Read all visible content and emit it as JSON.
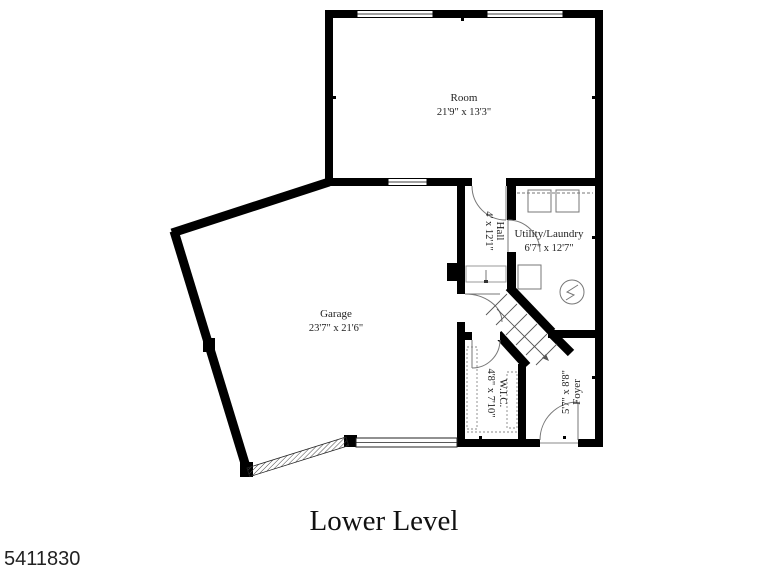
{
  "plan": {
    "title": "Lower Level",
    "mls_number": "5411830",
    "rooms": {
      "room": {
        "name": "Room",
        "dimensions": "21'9\" x 13'3\""
      },
      "garage": {
        "name": "Garage",
        "dimensions": "23'7\" x 21'6\""
      },
      "utility": {
        "name": "Utility/Laundry",
        "dimensions": "6'7\" x 12'7\""
      },
      "hall": {
        "name": "Hall",
        "dimensions": "4' x 12'1\""
      },
      "wic": {
        "name": "W.I.C.",
        "dimensions": "4'8\" x 7'10\""
      },
      "foyer": {
        "name": "Foyer",
        "dimensions": "5'7\" x 8'8\""
      }
    },
    "colors": {
      "wall": "#000000",
      "thin_line": "#777777",
      "text": "#222222",
      "background": "#ffffff"
    }
  }
}
